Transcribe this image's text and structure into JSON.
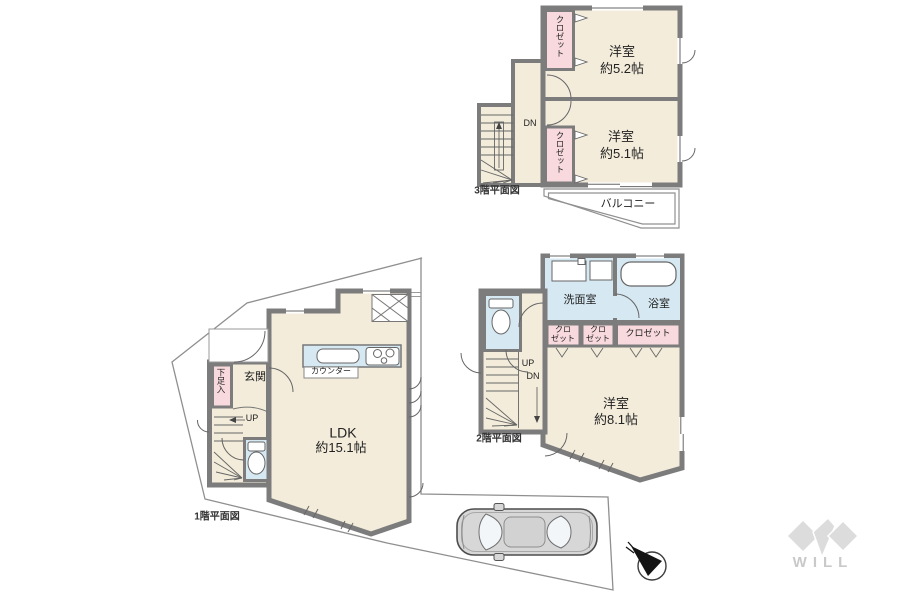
{
  "colors": {
    "room_fill": "#F3ECDB",
    "closet_fill": "#F8DADE",
    "wet_area_fill": "#D6E9F3",
    "wall": "#7C7C7C",
    "lot_line": "#8F8F8F",
    "logo_gray": "#DCDCDC"
  },
  "floor3": {
    "caption": "3階平面図",
    "rooms": [
      {
        "name": "洋室",
        "size": "約5.2帖"
      },
      {
        "name": "洋室",
        "size": "約5.1帖"
      }
    ],
    "closets": [
      "クロゼット",
      "クロゼット"
    ],
    "stair_down_label": "DN",
    "balcony_label": "バルコニー"
  },
  "floor2": {
    "caption": "2階平面図",
    "washroom_label": "洗面室",
    "bathroom_label": "浴室",
    "closets": [
      "クロ\nゼット",
      "クロ\nゼット",
      "クロゼット"
    ],
    "bedroom": {
      "name": "洋室",
      "size": "約8.1帖"
    },
    "stair_up_label": "UP",
    "stair_down_label": "DN"
  },
  "floor1": {
    "caption": "1階平面図",
    "entrance_label": "玄関",
    "shoe_storage_label": "下足入",
    "ldk": {
      "name": "LDK",
      "size": "約15.1帖"
    },
    "counter_label": "カウンター",
    "stair_up_label": "UP"
  },
  "logo": {
    "text": "WILL"
  }
}
